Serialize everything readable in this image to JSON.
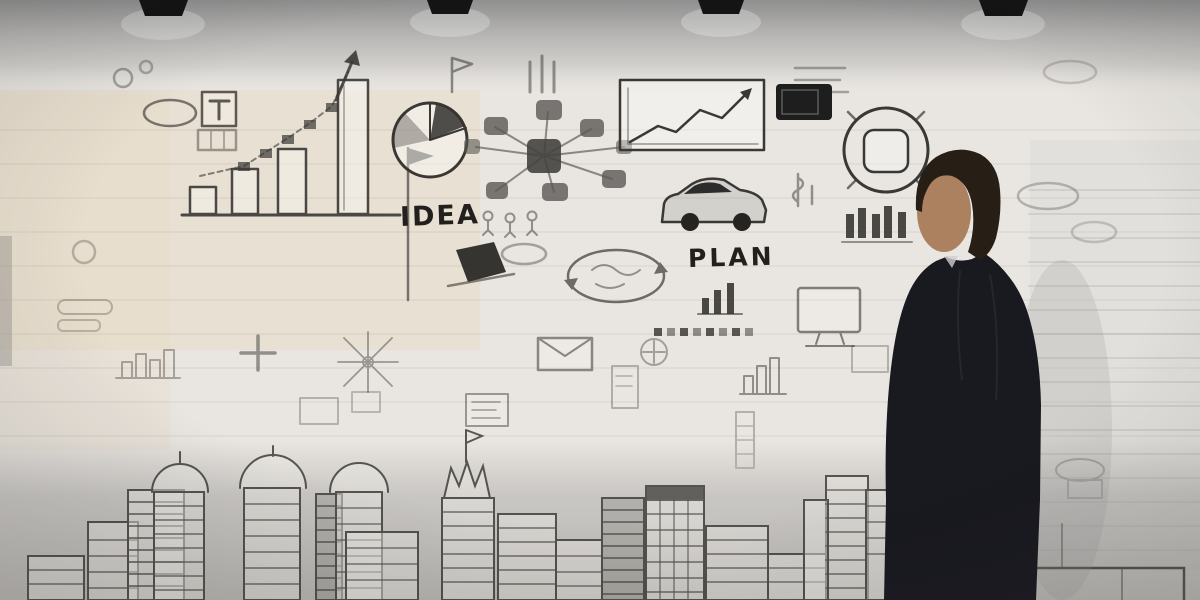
{
  "scene": {
    "description": "Businessman in a dark suit, hand raised to his head, standing at the right side of the frame and facing a light wall completely covered with hand-drawn business sketches: a rising bar chart with a stair-step arrow, pie chart, mind-map network, line chart, car, coin, clouds, envelope, monitor and a sketched city skyline along the bottom; four dark ceiling lights hang at the top edge.",
    "figure": "businessman-thinking",
    "ceiling_lights_count": 4
  },
  "wall_text": {
    "idea": "IDEA",
    "plan": "PLAN"
  },
  "doodles": [
    "cloud",
    "target-t-box",
    "growth-bar-chart",
    "stair-step-arrow",
    "flag-pole",
    "pie-chart",
    "idea-label",
    "mind-map-network",
    "stick-figures",
    "line-chart-box",
    "dark-tablet",
    "coin-circle",
    "currency-marks",
    "car-sketch",
    "plan-label",
    "mini-bar-chart",
    "dotted-list",
    "cycle-oval",
    "dark-laptop",
    "envelope",
    "monitor",
    "compass-star",
    "plus-sign",
    "document-sheet",
    "city-skyline",
    "dome-towers",
    "crown-building",
    "ceiling-lights",
    "businessman"
  ],
  "palette": {
    "ceiling_top": "#8f8f8f",
    "wall_light": "#e9e6e1",
    "wall_warm": "#e6d9c2",
    "sketch_ink": "#3a3835",
    "light_fixture": "#141414",
    "suit": "#191920",
    "hair": "#271e16",
    "skin": "#ab8160",
    "skyline_band": "#aeacaa"
  }
}
